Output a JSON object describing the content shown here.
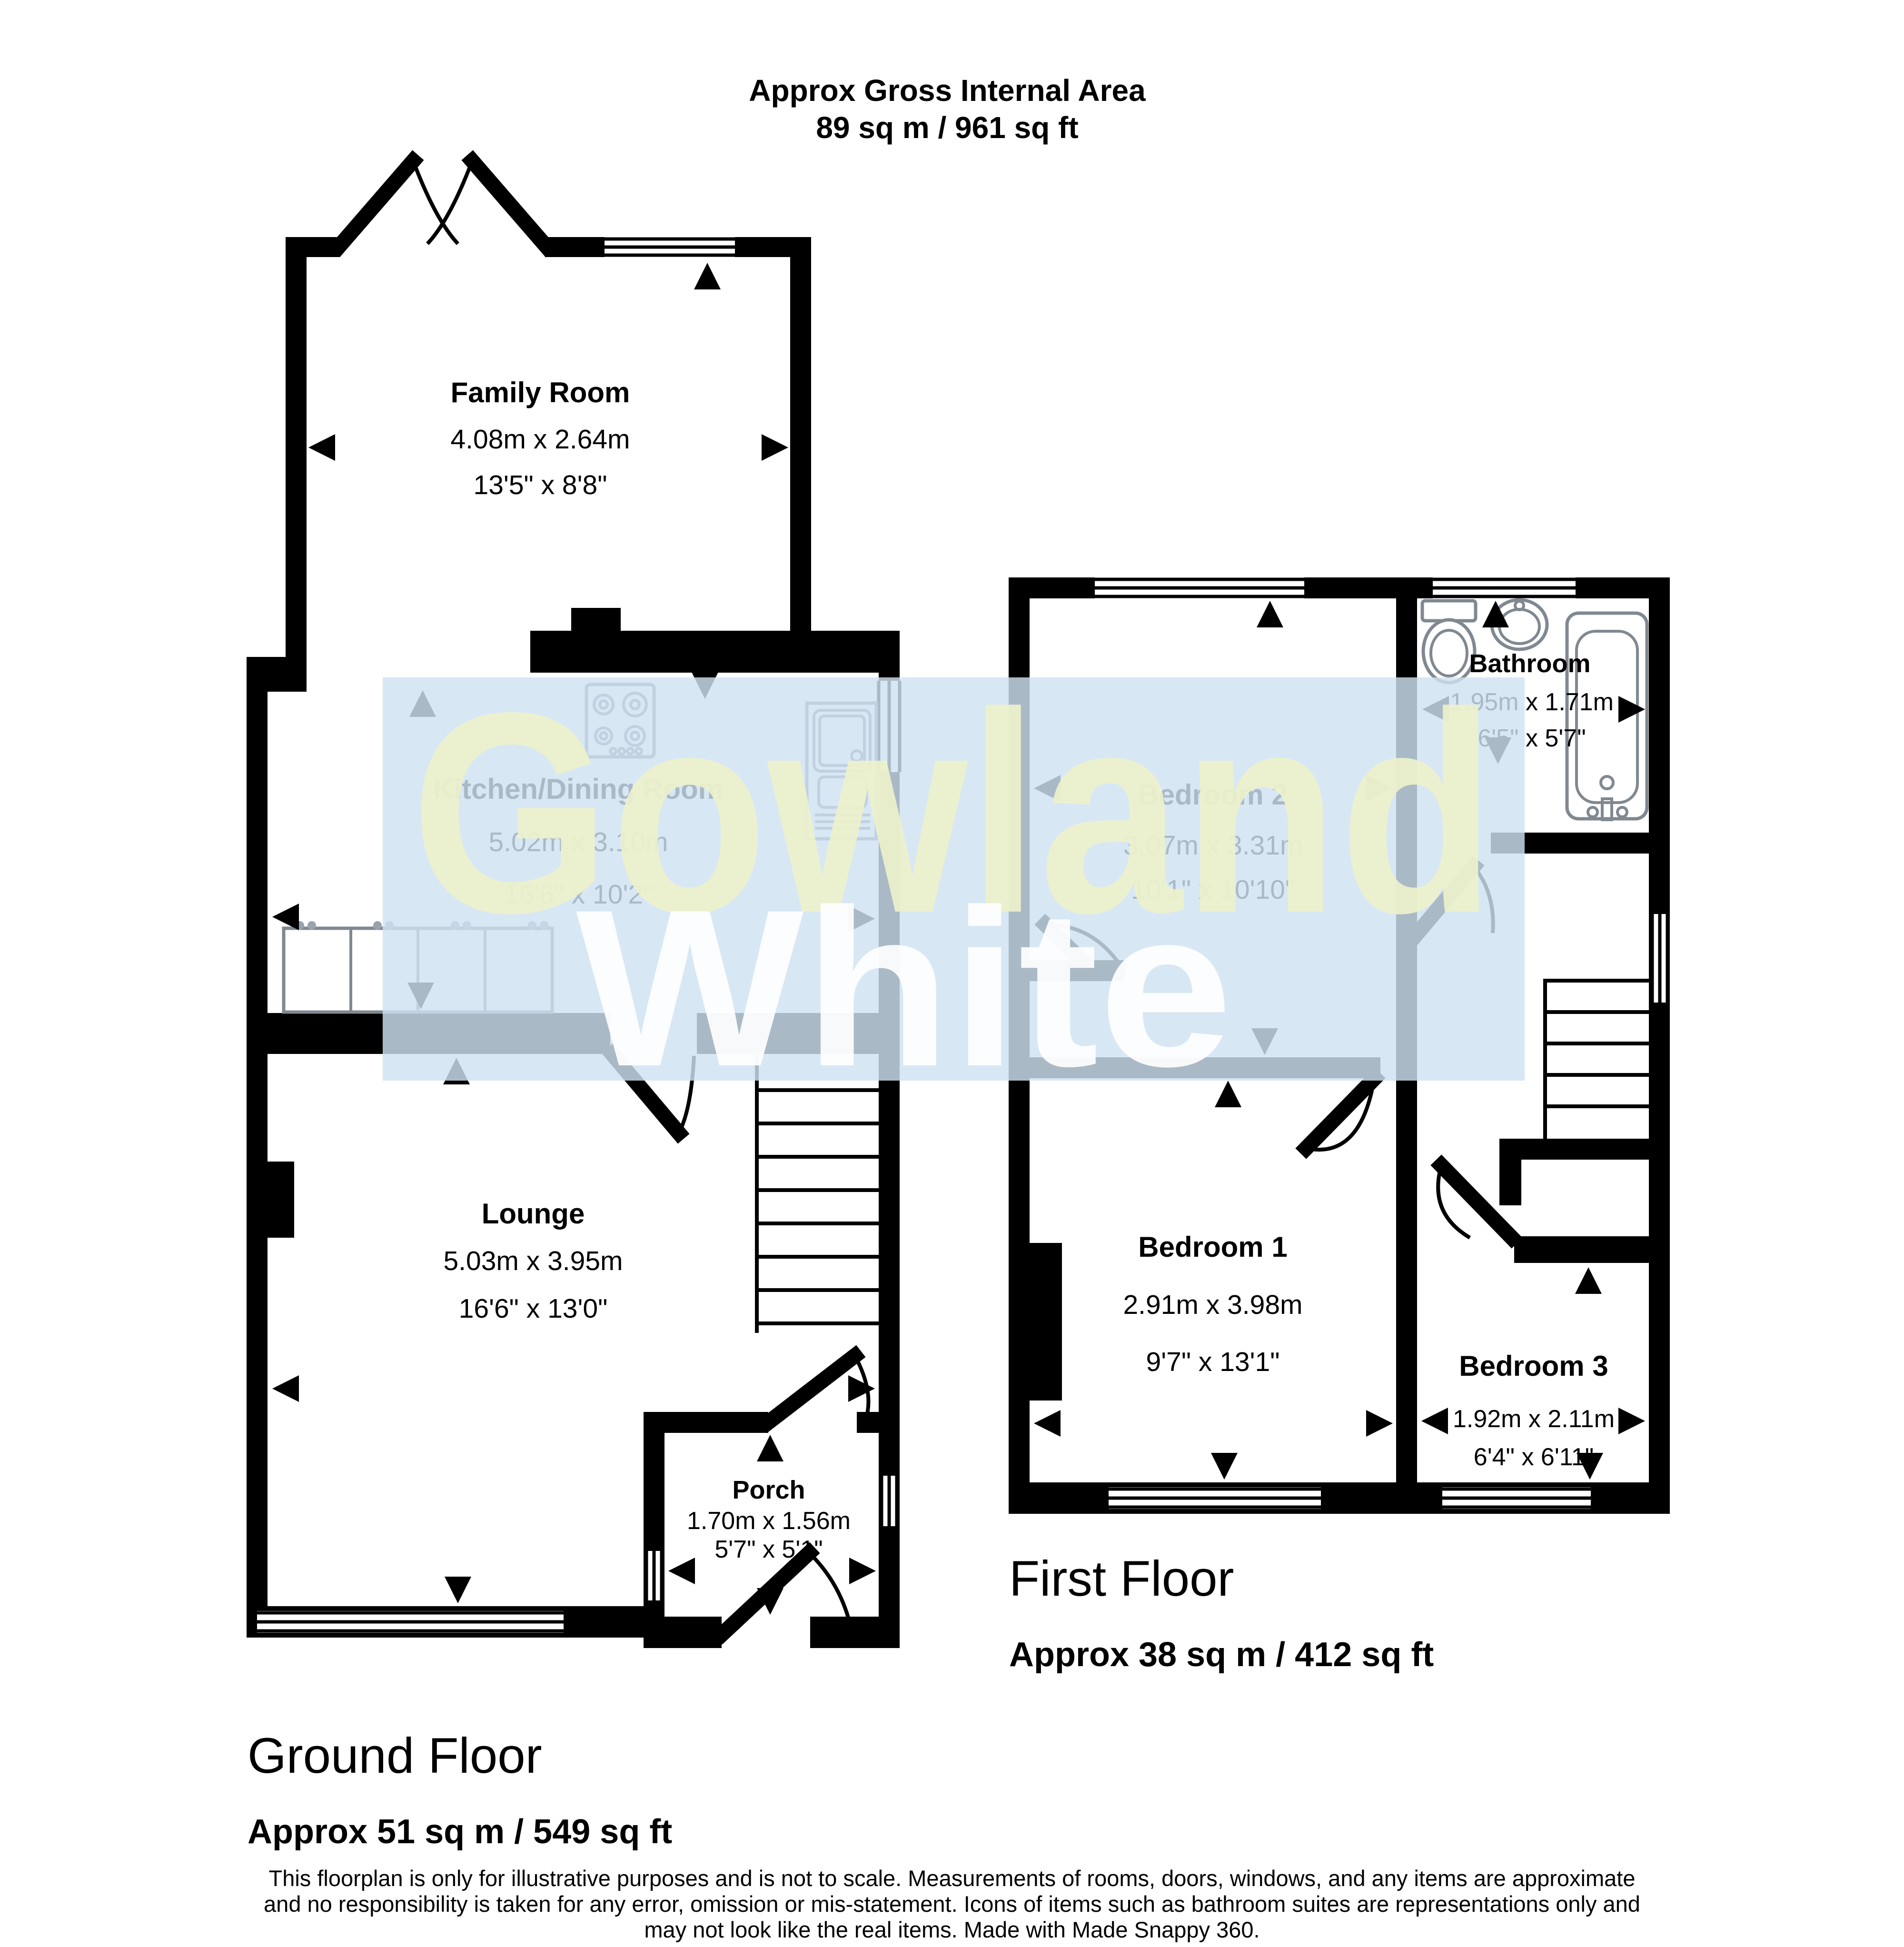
{
  "header": {
    "line1": "Approx Gross Internal Area",
    "line2": "89 sq m / 961 sq ft"
  },
  "watermark": {
    "line1": "Gowland",
    "line2": "White",
    "band_color": "#cfe2f2",
    "line1_color": "#edf2cc",
    "line2_color": "#ffffff"
  },
  "ground_floor": {
    "title": "Ground Floor",
    "area": "Approx 51 sq m / 549 sq ft",
    "rooms": {
      "family_room": {
        "name": "Family Room",
        "metric": "4.08m x 2.64m",
        "imperial": "13'5\" x 8'8\""
      },
      "kitchen": {
        "name": "Kitchen/Dining Room",
        "metric": "5.02m x 3.10m",
        "imperial": "16'6\" x 10'2\""
      },
      "lounge": {
        "name": "Lounge",
        "metric": "5.03m x 3.95m",
        "imperial": "16'6\" x 13'0\""
      },
      "porch": {
        "name": "Porch",
        "metric": "1.70m x 1.56m",
        "imperial": "5'7\" x 5'1\""
      }
    }
  },
  "first_floor": {
    "title": "First Floor",
    "area": "Approx 38 sq m / 412 sq ft",
    "rooms": {
      "bedroom2": {
        "name": "Bedroom 2",
        "metric": "3.07m x 3.31m",
        "imperial": "10'1\" x 10'10\""
      },
      "bathroom": {
        "name": "Bathroom",
        "metric": "1.95m x 1.71m",
        "imperial": "6'5\" x 5'7\""
      },
      "bedroom1": {
        "name": "Bedroom 1",
        "metric": "2.91m x 3.98m",
        "imperial": "9'7\" x 13'1\""
      },
      "bedroom3": {
        "name": "Bedroom 3",
        "metric": "1.92m x 2.11m",
        "imperial": "6'4\" x 6'11\""
      }
    }
  },
  "disclaimer": {
    "line1": "This floorplan is only for illustrative purposes and is not to scale. Measurements of rooms, doors, windows, and any items are approximate",
    "line2": "and no responsibility is taken for any error, omission or mis-statement. Icons of items such as bathroom suites are representations only and",
    "line3": "may not look like the real items. Made with Made Snappy 360."
  }
}
